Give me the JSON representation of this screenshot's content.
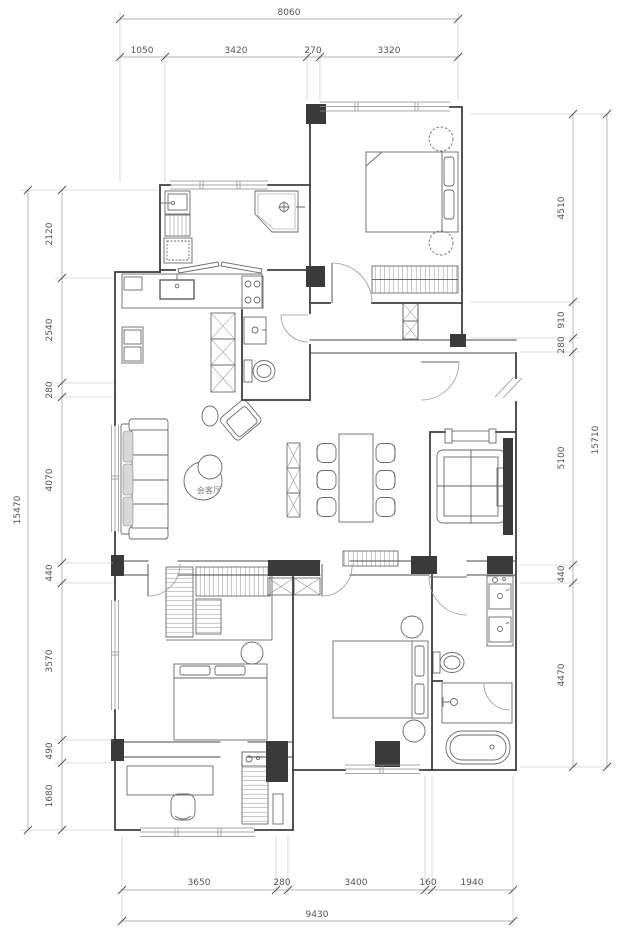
{
  "drawing": {
    "type": "apartment-floor-plan",
    "living_room_label": "会客厅"
  },
  "dimensions": {
    "top": {
      "total": "8060",
      "segments": [
        "1050",
        "3420",
        "270",
        "3320"
      ]
    },
    "bottom": {
      "total": "9430",
      "segments": [
        "3650",
        "280",
        "3400",
        "160",
        "1940"
      ]
    },
    "left": {
      "total": "15470",
      "segments": [
        "2120",
        "2540",
        "280",
        "4070",
        "440",
        "3570",
        "490",
        "1680"
      ]
    },
    "right": {
      "total": "15710",
      "segments": [
        "4510",
        "910",
        "280",
        "5100",
        "440",
        "4470"
      ]
    }
  },
  "colors": {
    "background": "#ffffff",
    "wall_line": "#3f3f3f",
    "furniture_line": "#6a6a6a",
    "dimension_text": "#555555",
    "column_fill": "#3a3a3a"
  },
  "symbols": [
    "double-bed",
    "wardrobe",
    "nightstand-stool",
    "elevator-shaft",
    "entry-break",
    "door-swing",
    "window",
    "sofa",
    "coffee-table",
    "armchair",
    "side-table",
    "dining-table",
    "dining-chair",
    "sideboard",
    "kitchen-counter",
    "kitchen-sink",
    "gas-stove",
    "tall-cabinet",
    "washing-machine",
    "laundry-sink",
    "corner-shower",
    "folding-door",
    "toilet",
    "vanity-sink",
    "shower-enclosure",
    "bathtub",
    "walk-in-closet",
    "desk",
    "desk-chair",
    "bookshelf"
  ]
}
